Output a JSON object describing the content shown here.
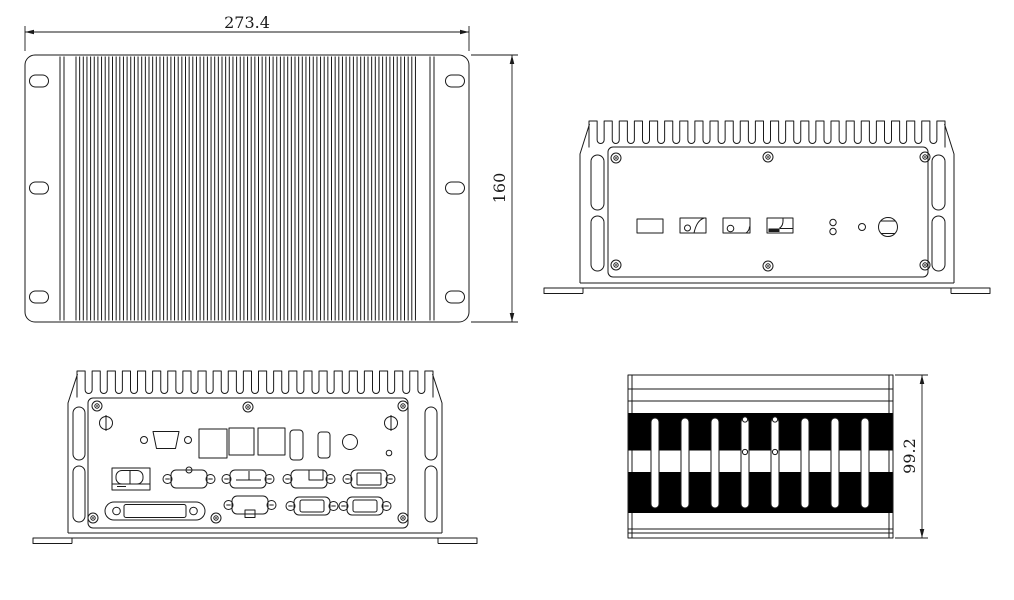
{
  "drawing": {
    "colors": {
      "line": "#1a1a1a",
      "fill": "#000000",
      "background": "#ffffff"
    },
    "dimensions": {
      "top_width": "273.4",
      "top_height": "160",
      "side_height": "99.2"
    }
  }
}
